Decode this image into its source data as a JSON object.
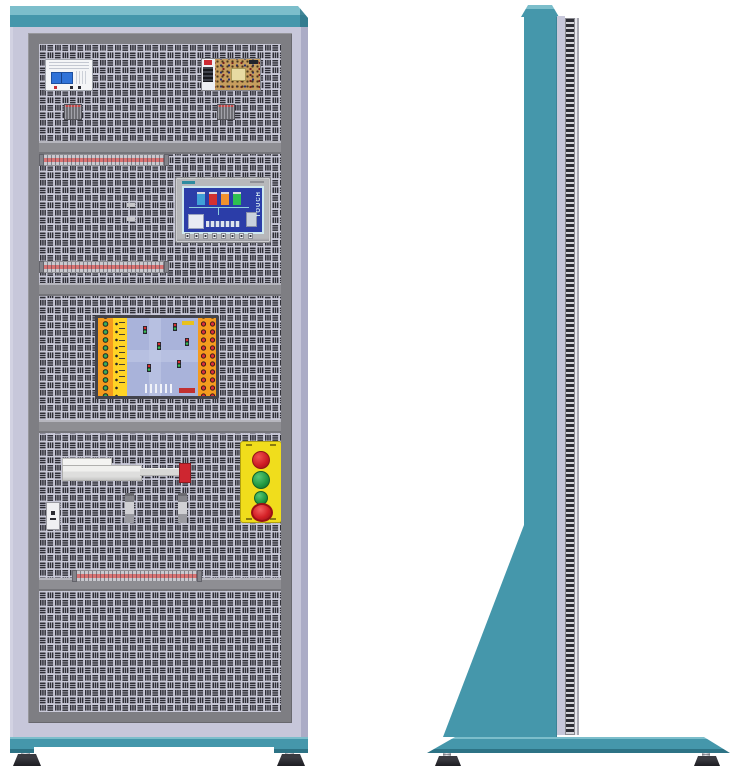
{
  "drawing": {
    "subject": "industrial-training-cabinet-elevation",
    "views": {
      "front": "front-elevation",
      "side": "side-elevation"
    }
  },
  "theme": {
    "teal": "#4597ab",
    "teal_light": "#7cbecb",
    "teal_dark": "#2d7385",
    "lavender": "#c7c7da",
    "lavender_dark": "#abacc6",
    "frame_gray": "#7e7e83",
    "panel_bg": "#c9c9d8",
    "slot": "#2e2e36",
    "divider": "#8e8e93",
    "breaker_blue": "#2f72d8",
    "psu_pcb": "#c79e5e",
    "hmi_bezel": "#b7b8bb",
    "hmi_screen": "#2b3da8",
    "screen_border": "#cfe9f0",
    "board_orange": "#f59b1e",
    "board_yellow": "#ffd425",
    "board_center": "#a9b3da",
    "button_yellow": "#f0dd1c",
    "red": "#ce2630",
    "green": "#2aa548",
    "tstrip_red": "#d87272",
    "steel": "#c7c7cc",
    "black": "#1d1d22"
  },
  "front_view": {
    "components": {
      "circuit_breaker": {
        "name": "2-pole miniature circuit breaker"
      },
      "power_supply": {
        "name": "open-frame switch-mode power supply"
      },
      "terminal_strip_top": {
        "name": "terminal strip"
      },
      "relay_group": {
        "name": "relay block group (4 x 2)"
      },
      "hmi": {
        "name": "HMI touch panel",
        "screen_text": "TOUCH"
      },
      "terminal_strip_mid": {
        "name": "terminal strip"
      },
      "simulation_board": {
        "name": "traffic-light simulation training board"
      },
      "pneumatic_cylinder": {
        "name": "pneumatic cylinder with red end cap"
      },
      "sensor_left": {
        "name": "sensor module"
      },
      "sensor_mid": {
        "name": "proximity sensor"
      },
      "sensor_right": {
        "name": "proximity sensor"
      },
      "push_button_station": {
        "name": "push-button station: red, green, green, emergency-stop"
      },
      "terminal_strip_bottom": {
        "name": "terminal strip"
      }
    }
  },
  "side_view": {
    "components": {
      "column": {
        "name": "cabinet column"
      },
      "gusset": {
        "name": "triangular base gusset"
      },
      "panel_edge": {
        "name": "perforated panel edge"
      },
      "base_plate": {
        "name": "floor base plate"
      },
      "feet": {
        "name": "adjustable leveling feet"
      }
    }
  }
}
